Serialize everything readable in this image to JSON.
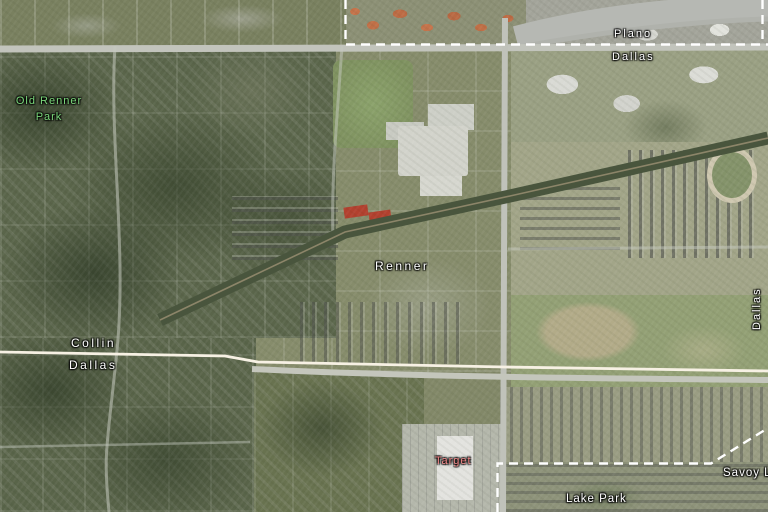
{
  "map": {
    "view": "aerial-satellite",
    "labels": {
      "plano": "Plano",
      "dallas_city": "Dallas",
      "old_renner_park_line1": "Old Renner",
      "old_renner_park_line2": "Park",
      "renner": "Renner",
      "collin_county": "Collin",
      "dallas_county": "Dallas",
      "dallas_edge": "Dallas",
      "target_store": "Target",
      "lake_park": "Lake Park",
      "savoy": "Savoy L"
    },
    "colors": {
      "label_text": "#ffffff",
      "park_label_green": "#7bd87b",
      "store_label_red": "#ef8585",
      "city_boundary_dashed": "#ffffff",
      "county_line_solid": "#f7f1e4"
    }
  }
}
